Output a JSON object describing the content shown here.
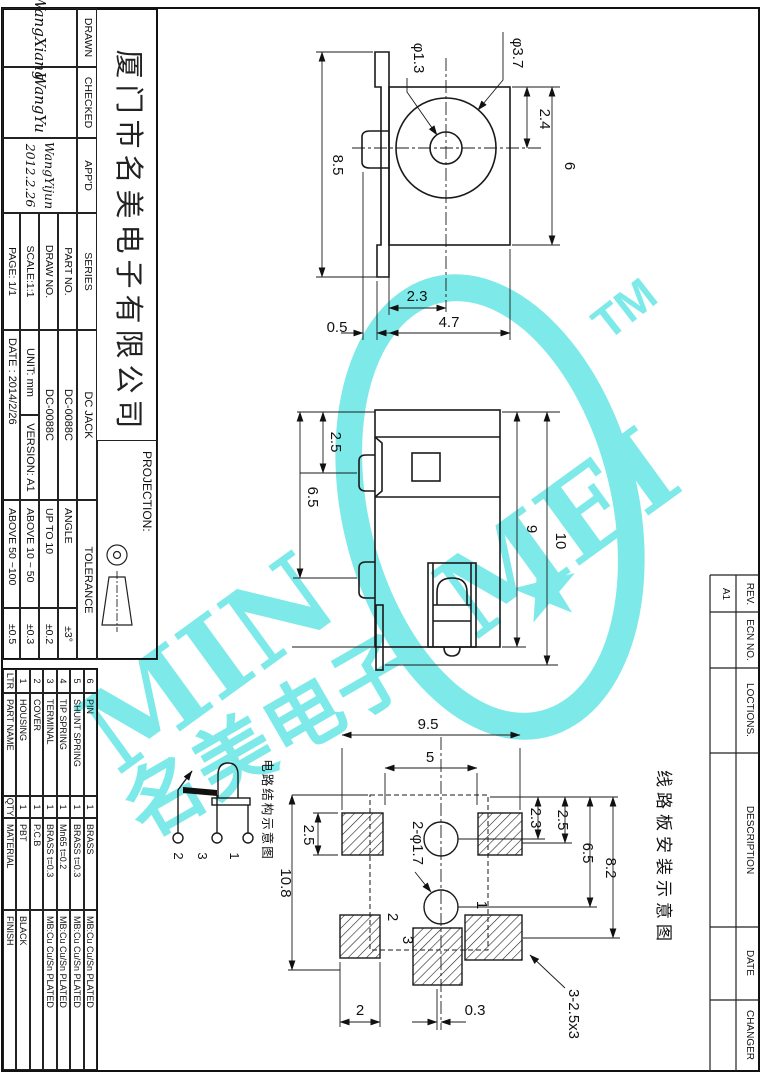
{
  "company_name": "厦门市名美电子有限公司",
  "title_block": {
    "drawn_label": "DRAWN",
    "drawn_signature": "WangXiang",
    "checked_label": "CHECKED",
    "checked_signature": "WangYu",
    "appd_label": "APP'D",
    "appd_signature": "WangYijun",
    "appd_date": "2012.2.26",
    "series_label": "SERIES",
    "series_value": "DC JACK",
    "part_no_label": "PART NO.",
    "part_no_value": "DC-0088C",
    "draw_no_label": "DRAW NO.",
    "draw_no_value": "DC-0088C",
    "scale": "SCALE:1:1",
    "unit": "UNIT: mm",
    "version": "VERSION: A1",
    "page": "PAGE: 1/1",
    "date": "DATE : 2014/2/26",
    "projection_label": "PROJECTION:",
    "tolerance_header": "TOLERANCE",
    "tolerance_rows": [
      [
        "ANGLE",
        "±3°"
      ],
      [
        "UP TO 10",
        "±0.2"
      ],
      [
        "ABOVE 10 ~ 50",
        "±0.3"
      ],
      [
        "ABOVE 50 ~100",
        "±0.5"
      ]
    ]
  },
  "bom": {
    "headers": [
      "LTR",
      "PART NAME",
      "QTY",
      "MATERIAL",
      "FINISH"
    ],
    "rows": [
      [
        "6",
        "PIN",
        "1",
        "BRASS",
        "MB:Cu Cu/Sn PLATED"
      ],
      [
        "5",
        "SHUNT SPRING",
        "1",
        "BRASS t=0.3",
        "MB:Cu Cu/Sn PLATED"
      ],
      [
        "4",
        "TIP SPRING",
        "1",
        "Mn65 t=0.2",
        "MB:Cu Cu/Sn PLATED"
      ],
      [
        "3",
        "TERMINAL",
        "1",
        "BRASS t=0.3",
        "MB:Cu Cu/Sn PLATED"
      ],
      [
        "2",
        "COVER",
        "1",
        "P.C.B",
        ""
      ],
      [
        "1",
        "HOUSING",
        "1",
        "PBT",
        "BLACK"
      ]
    ]
  },
  "revision_table": {
    "rev_label": "REV.",
    "rev_value": "A1",
    "ecn_label": "ECN NO.",
    "locations_label": "LOCTIONS.",
    "description_label": "DESCRIPTION",
    "date_label": "DATE",
    "changer_label": "CHANGER"
  },
  "front_view": {
    "dim_height": "8.5",
    "dim_hole": "φ1.3",
    "dim_barrel": "φ3.7",
    "dim_top_to_center": "2.4",
    "dim_body_height": "6",
    "dim_left_to_center": "2.3",
    "dim_width": "4.7",
    "dim_flange": "0.5"
  },
  "side_view": {
    "dim_top_lug": "2.5",
    "dim_lug_pitch": "6.5",
    "dim_body": "9",
    "dim_overall": "10"
  },
  "pcb_view": {
    "caption": "线路板安装示意图",
    "dim_outer": "9.5",
    "dim_inner": "5",
    "dim_pad": "2.5",
    "dim_overall": "10.8",
    "dim_hole1": "2.3",
    "dim_hole2": "2.5",
    "dim_hole_pitch": "6.5",
    "dim_pad_row": "8.2",
    "dim_pad_w": "2",
    "dim_offset": "0.3",
    "holes_note": "2-φ1.7",
    "pads_note": "3-2.5x3",
    "pin1": "1",
    "pin2": "2",
    "pin3": "3"
  },
  "schematic": {
    "caption": "电路结构示意图",
    "pin1": "1",
    "pin2": "2",
    "pin3": "3"
  },
  "watermark": {
    "text_min": "MIN",
    "text_mei": "MEI",
    "tm": "TM",
    "text_cjk": "名美电子",
    "star": "★",
    "color": "#7de9e9"
  }
}
